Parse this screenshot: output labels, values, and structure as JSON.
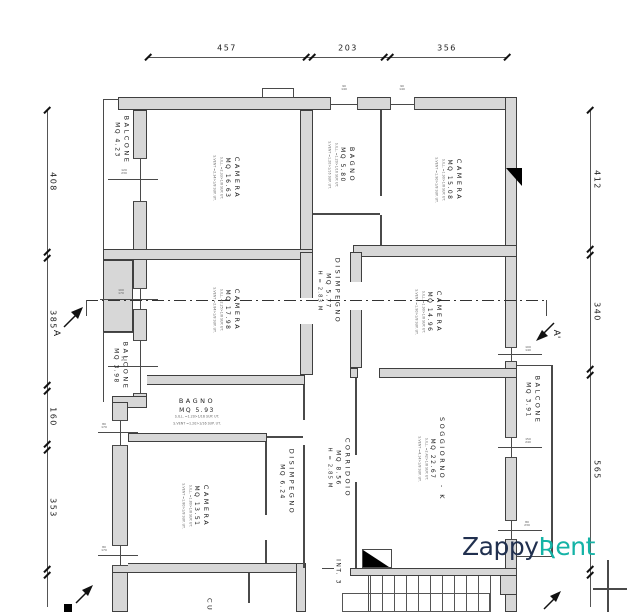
{
  "logo": {
    "zappy": "Zappy",
    "rent": "Ʀent",
    "navy": "#21304f",
    "teal": "#14b3a6"
  },
  "dims": {
    "top": [
      "457",
      "203",
      "356"
    ],
    "left": [
      "408",
      "385",
      "160",
      "353"
    ],
    "right": [
      "412",
      "340",
      "565"
    ]
  },
  "section": {
    "a": "A",
    "a1": "A'"
  },
  "unit": {
    "label": "INT. 3"
  },
  "rooms": {
    "balcone1": {
      "name": "BALCONE",
      "area": "MQ 4.23"
    },
    "camera1": {
      "name": "CAMERA",
      "area": "MQ 16.63",
      "ill": "S.ILL. =2.33>1/8 SUP. UT.",
      "vent": "S.VENT =2.34>1/8 SUP. UT."
    },
    "bagno1": {
      "name": "BAGNO",
      "area": "MQ 5.80",
      "ill": "S.ILL. =1.20>1/16 SUP. UT.",
      "vent": "S.VENT =1.20>1/16 SUP. UT."
    },
    "camera2": {
      "name": "CAMERA",
      "area": "MQ 15.08",
      "ill": "S.ILL. =1.90>1/8 SUP. UT.",
      "vent": "S.VENT =1.90>1/8 SUP. UT."
    },
    "disimpegno1": {
      "name": "DISIMPEGNO",
      "area": "MQ 5.77",
      "height": "H = 2.83 M"
    },
    "camera3": {
      "name": "CAMERA",
      "area": "MQ 17.98",
      "ill": "S.ILL. =2.25>1/8 SUP. UT.",
      "vent": "S.VENT =2.84>1/8 SUP. UT."
    },
    "balcone2": {
      "name": "BALCONE",
      "area": "MQ 3.98"
    },
    "camera4": {
      "name": "CAMERA",
      "area": "MQ 14.96",
      "ill": "S.ILL. =1.90>1/8 SUP. UT.",
      "vent": "S.VENT =1.90>1/8 SUP. UT."
    },
    "bagno2": {
      "name": "BAGNO",
      "area": "MQ 5.93",
      "ill": "S.ILL. =1.20>1/16 SUP. UT.",
      "vent": "S.VENT =1.20>1/16 SUP. UT."
    },
    "camera5": {
      "name": "CAMERA",
      "area": "MQ 13.51",
      "ill": "S.ILL. =1.80>1/8 SUP. UT.",
      "vent": "S.VENT =1.80>1/8 SUP. UT."
    },
    "disimpegno2": {
      "name": "DISIMPEGNO",
      "area": "MQ 6.24"
    },
    "corridoio": {
      "name": "CORRIDOIO",
      "area": "MQ 8.56",
      "height": "H = 2.85 M"
    },
    "soggiorno": {
      "name": "SOGGIORNO - K",
      "area": "MQ 22.67",
      "ill": "S.ILL. =2.42>1/8 SUP. UT.",
      "vent": "S.VENT =4.14>1/8 SUP. UT."
    },
    "balcone3": {
      "name": "BALCONE",
      "area": "MQ 3.91"
    },
    "cucina": {
      "name": "CUCINA",
      "area": "MQ"
    }
  },
  "tags": [
    {
      "w": "120",
      "h": "230"
    },
    {
      "w": "100",
      "h": "170"
    },
    {
      "w": "120",
      "h": "230"
    },
    {
      "w": "80",
      "h": "170"
    },
    {
      "w": "80",
      "h": "170"
    },
    {
      "w": "90",
      "h": "140"
    },
    {
      "w": "90",
      "h": "140"
    },
    {
      "w": "100",
      "h": "140"
    },
    {
      "w": "150",
      "h": "240"
    },
    {
      "w": "80",
      "h": "230"
    }
  ]
}
